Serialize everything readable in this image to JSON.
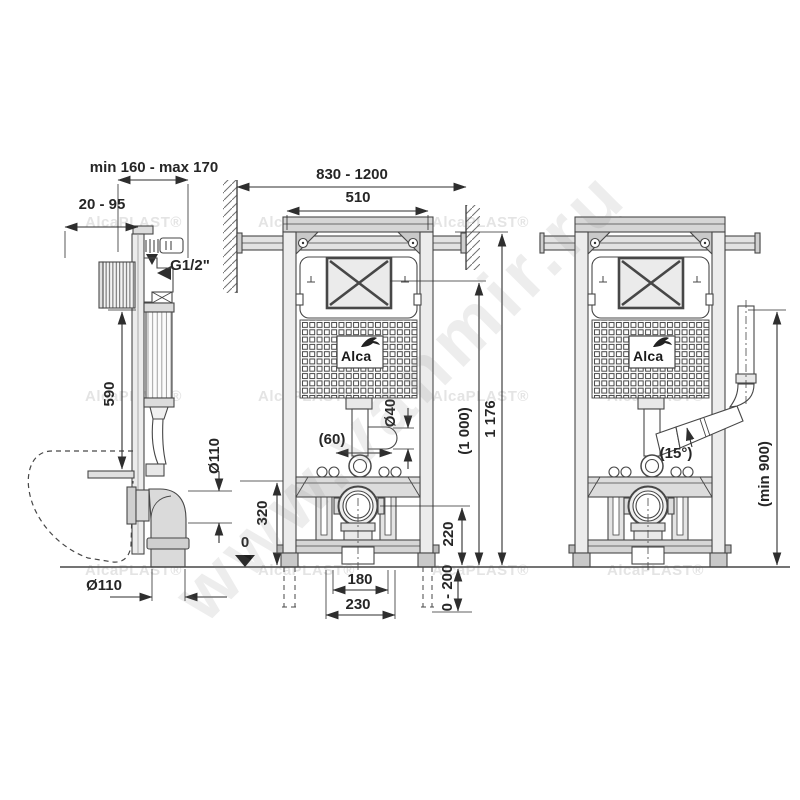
{
  "watermark": {
    "tile": "AlcaPLAST®",
    "diagonal": "www.vanmir.ru"
  },
  "logo": {
    "brand": "Alca"
  },
  "side_view": {
    "depth_range": "min 160 - max 170",
    "front_offset": "20 - 95",
    "water_thread": "G1/2\"",
    "flush_height": "590",
    "elbow_diameter": "Ø110",
    "outlet_diameter": "Ø110",
    "floor_level": "0",
    "bracket_height": "320"
  },
  "front_view": {
    "rail_span": "830 - 1200",
    "frame_width": "510",
    "total_height": "1 176",
    "plate_height": "(1 000)",
    "flush_pipe_offset": "(60)",
    "flush_pipe_diameter": "Ø40",
    "drain_center_height": "220",
    "leg_adjust_range": "0 - 200",
    "bolt_spacing": "180",
    "outlet_spacing": "230"
  },
  "outlet_view": {
    "pipe_angle": "(15°)",
    "standpipe_min_height": "(min 900)"
  }
}
